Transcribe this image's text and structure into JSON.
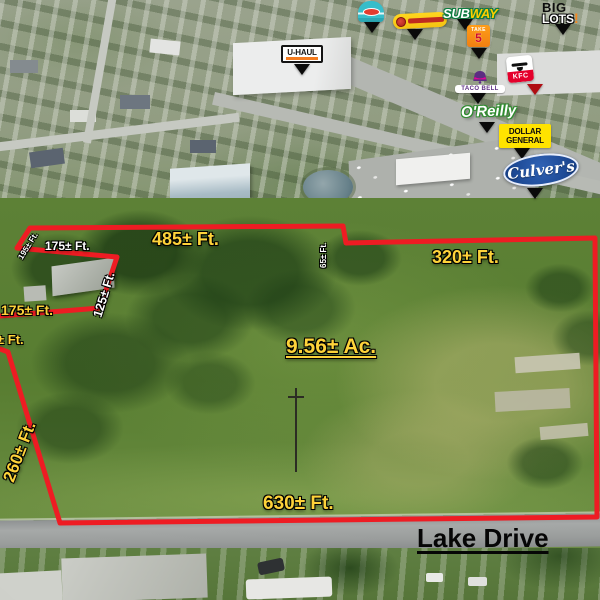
{
  "parcel": {
    "area_label": "9.56± Ac.",
    "street_name": "Lake Drive",
    "dimensions": {
      "top": "485± Ft.",
      "top_right": "320± Ft.",
      "bottom": "630± Ft.",
      "left_diagonal": "260± Ft.",
      "left_segment": "175± Ft.",
      "left_edge_partial": "± Ft.",
      "notch_bottom": "175± Ft.",
      "notch_side": "125± Ft.",
      "notch_corner": "195± Ft.",
      "top_jog": "65± Ft."
    }
  },
  "businesses": {
    "uhaul": "U-HAUL",
    "subway": {
      "sub": "SUB",
      "way": "WAY"
    },
    "big_lots": {
      "big": "BIG",
      "lots": "LOTS",
      "bang": "!"
    },
    "take5": {
      "take": "TAKE",
      "five": "5"
    },
    "taco_bell": "TACO BELL",
    "kfc": "KFC",
    "oreilly": "O'Reilly",
    "dollar_general": {
      "line1": "DOLLAR",
      "line2": "GENERAL"
    },
    "culvers": "Culver's"
  },
  "colors": {
    "boundary_red": "#ee1c23",
    "measurement_yellow": "#fed33a",
    "measurement_white": "#ffffff",
    "street_label_black": "#060606",
    "uhaul_orange": "#f47c20",
    "subway_green": "#0c7c3f",
    "subway_yellow": "#ffce00",
    "taco_bell_purple": "#5c2d82",
    "kfc_red": "#e4002b",
    "oreilly_green": "#2f8c2f",
    "dollar_general_yellow": "#ffe300",
    "culvers_blue": "#1b4690",
    "big_lots_orange": "#f6871f",
    "take5_orange": "#f07f12"
  }
}
